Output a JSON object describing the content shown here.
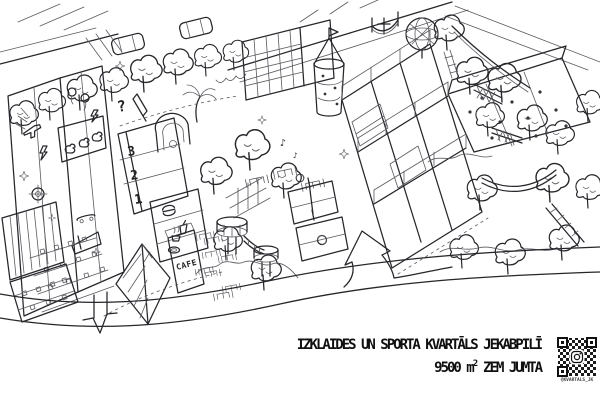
{
  "caption": {
    "title_line1": "IZKLAIDES UN SPORTA KVARTĀLS JEKABPILĪ",
    "area_value": "9500 m",
    "area_exponent": "2",
    "area_text": "ZEM JUMTA",
    "qr_handle": "@KVARTALS_JK"
  },
  "labels": {
    "cafe_sign": "CAFE",
    "floor_numbers": [
      "3",
      "2",
      "1"
    ],
    "question_sign": "?",
    "music_note": "♪"
  },
  "colors": {
    "ink": "#26262b",
    "pencil": "#5a5a60",
    "paper": "#ffffff"
  },
  "icons": [
    "tree-icon",
    "car-icon",
    "table-chairs-icon",
    "sparkle-icon",
    "seat-icon",
    "laser-gun-icon",
    "target-icon",
    "balloon-icon",
    "lightning-icon",
    "duck-icon",
    "skateboard-icon",
    "ramp-icon",
    "grandstand-seats",
    "podium-floor-numbers",
    "pencil-icon",
    "arch-playhouse",
    "palm-icon",
    "burger-icon",
    "drink-cup-icon",
    "plate-icon",
    "coffee-cup-icon",
    "climbing-net",
    "globe-icon",
    "flag-cross-icon",
    "climbing-wall-holds",
    "climbing-tower",
    "volleyball-icon",
    "barrel-platform",
    "rope-bridge",
    "zipline-cable",
    "ladder-icon",
    "hammock-icon",
    "road-lines",
    "entrance-down-arrow",
    "big-curved-arrow",
    "qr-code",
    "instagram-camera-icon"
  ]
}
